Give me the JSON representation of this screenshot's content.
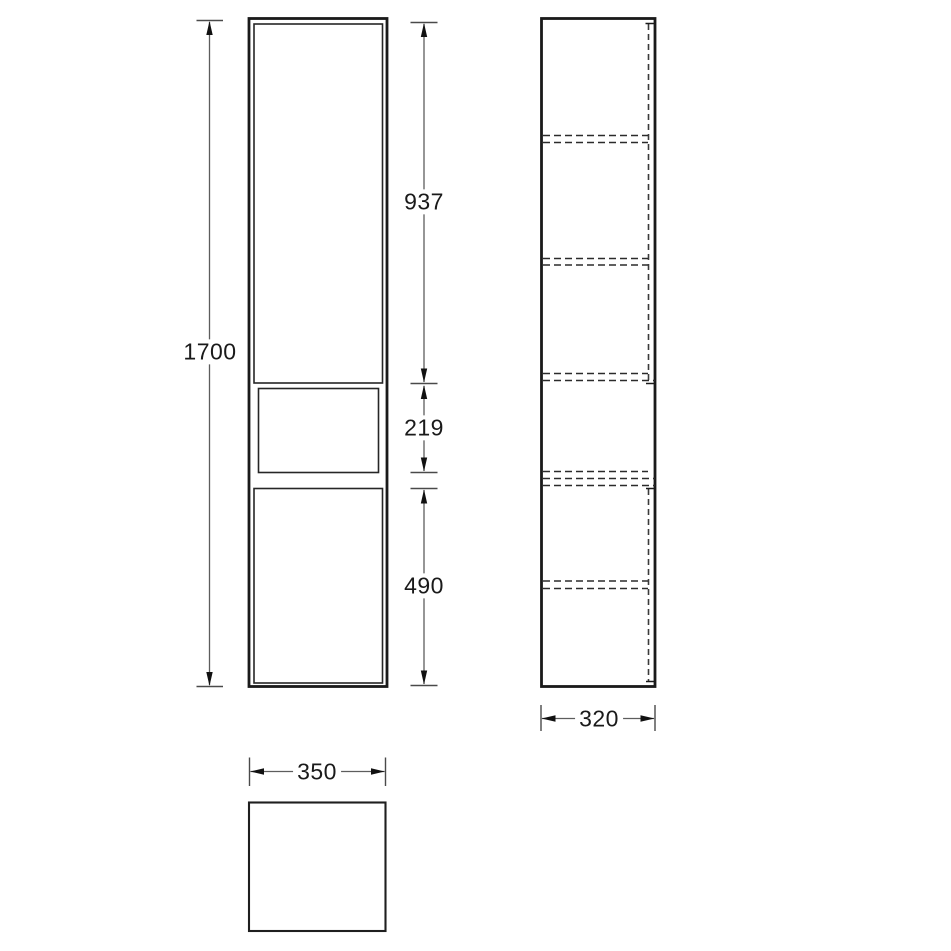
{
  "drawing": {
    "kind": "furniture technical drawing",
    "subject": "tall wall-hung cabinet - front elevation, side section and plan views",
    "colors": {
      "background": "#ffffff",
      "object_line": "#1a1a1a",
      "hidden_line": "#2b2b2b",
      "dimension_line": "#5d5d5d",
      "text": "#1a1a1a"
    },
    "dimensions": {
      "total_height": "1700",
      "upper_door_height": "937",
      "open_shelf_height": "219",
      "lower_door_height": "490",
      "depth": "320",
      "width": "350"
    }
  }
}
